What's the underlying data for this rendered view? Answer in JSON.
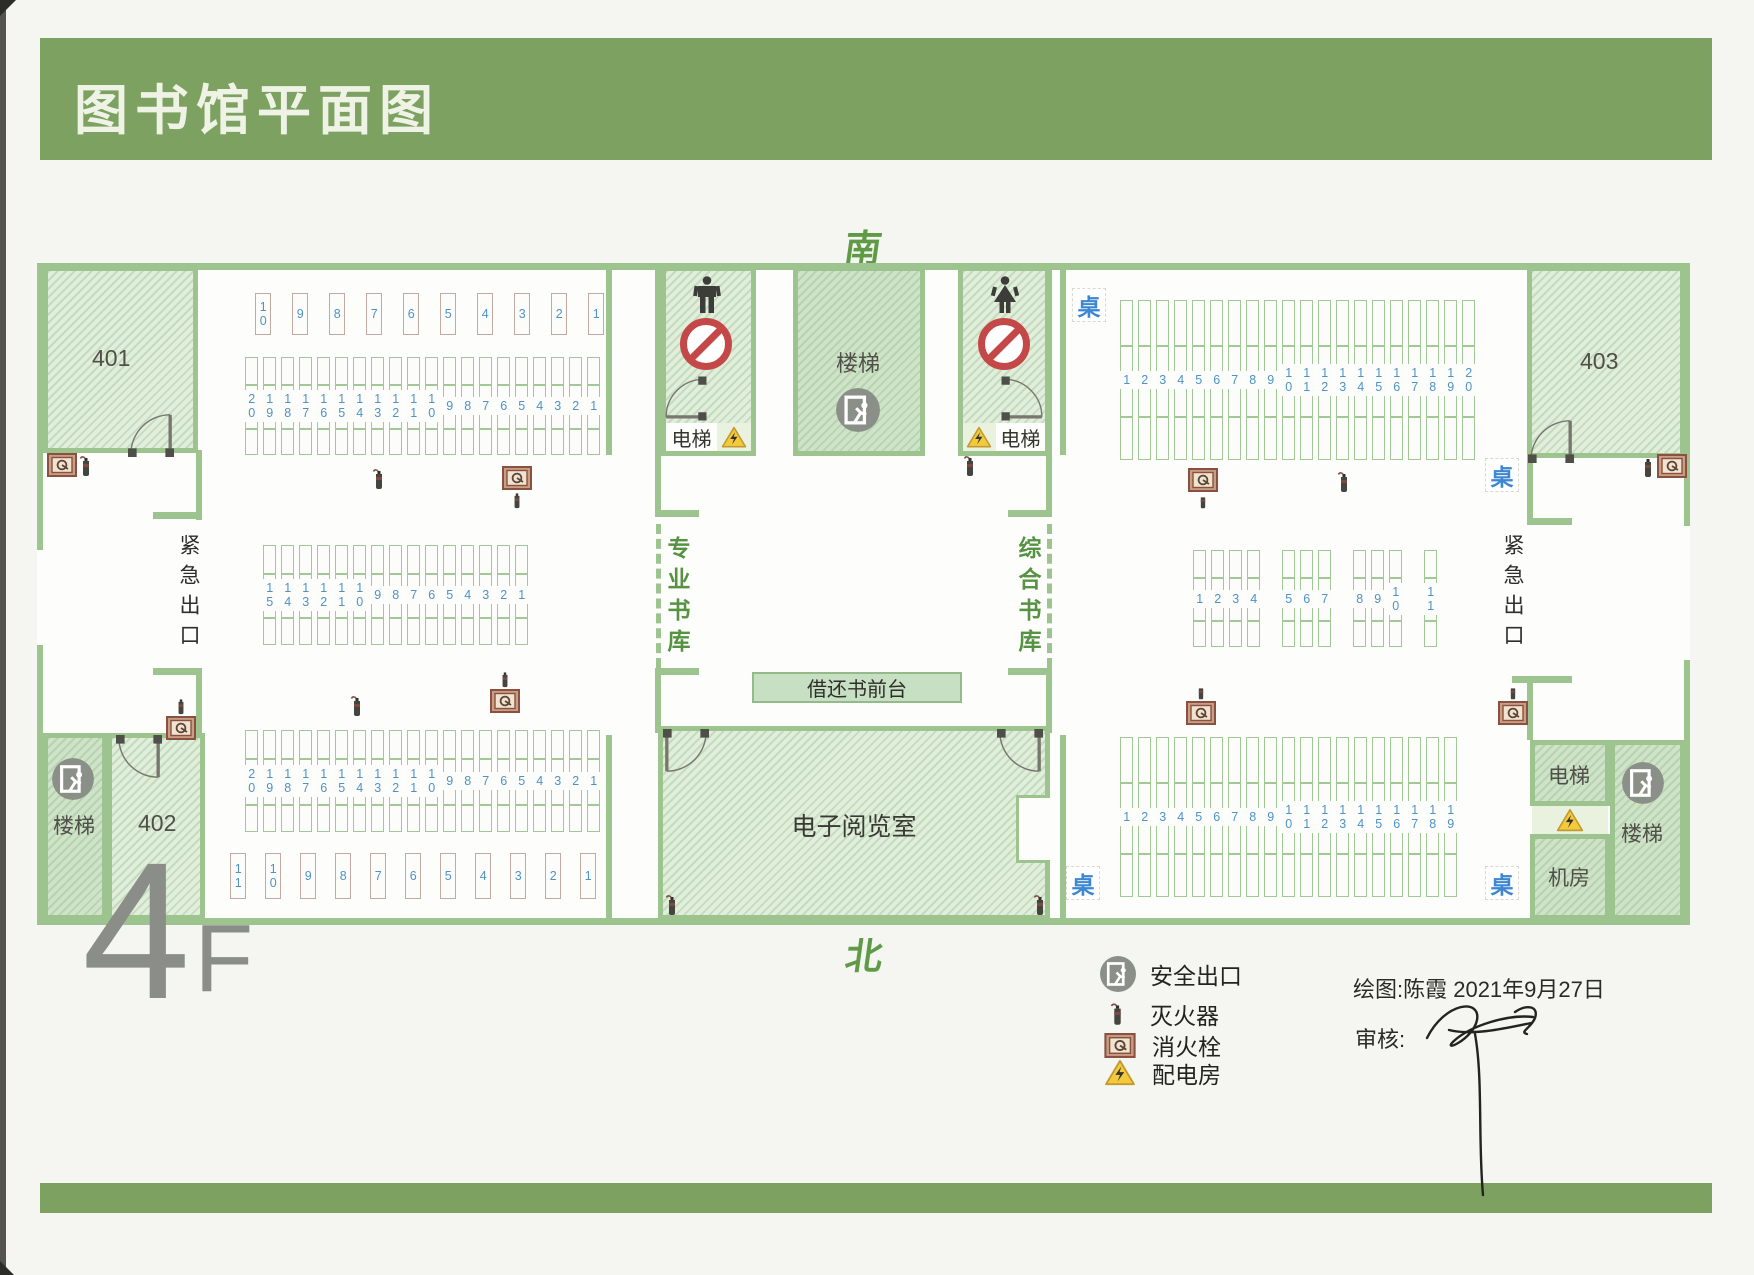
{
  "banner": {
    "title": "图书馆平面图"
  },
  "floor_label": {
    "big": "4",
    "small": "F"
  },
  "compass": {
    "south": "南",
    "north": "北",
    "east": "东",
    "west": "西"
  },
  "left_wing": {
    "room401": "401",
    "room402": "402",
    "stairs_label": "楼梯",
    "emergency_exit": "紧急出口",
    "rows": {
      "top": [
        "10",
        "9",
        "8",
        "7",
        "6",
        "5",
        "4",
        "3",
        "2",
        "1"
      ],
      "r2": [
        "20",
        "19",
        "18",
        "17",
        "16",
        "15",
        "14",
        "13",
        "12",
        "11",
        "10",
        "9",
        "8",
        "7",
        "6",
        "5",
        "4",
        "3",
        "2",
        "1"
      ],
      "r3": [
        "15",
        "14",
        "13",
        "12",
        "11",
        "10",
        "9",
        "8",
        "7",
        "6",
        "5",
        "4",
        "3",
        "2",
        "1"
      ],
      "r4": [
        "20",
        "19",
        "18",
        "17",
        "16",
        "15",
        "14",
        "13",
        "12",
        "11",
        "10",
        "9",
        "8",
        "7",
        "6",
        "5",
        "4",
        "3",
        "2",
        "1"
      ],
      "bottom": [
        "11",
        "10",
        "9",
        "8",
        "7",
        "6",
        "5",
        "4",
        "3",
        "2",
        "1"
      ]
    }
  },
  "center": {
    "stairs_label": "楼梯",
    "elevator_left": "电梯",
    "elevator_right": "电梯",
    "gate_left": "专业书库",
    "gate_right": "综合书库",
    "front_desk": "借还书前台",
    "reading_room": "电子阅览室"
  },
  "right_wing": {
    "room403": "403",
    "emergency_exit": "紧急出口",
    "elevator": "电梯",
    "machine_room": "机房",
    "stairs_label": "楼梯",
    "table_label": "桌",
    "rows": {
      "r1": [
        "1",
        "2",
        "3",
        "4",
        "5",
        "6",
        "7",
        "8",
        "9",
        "10",
        "11",
        "12",
        "13",
        "14",
        "15",
        "16",
        "17",
        "18",
        "19",
        "20"
      ],
      "r2_groups": [
        [
          "1",
          "2",
          "3",
          "4"
        ],
        [
          "5",
          "6",
          "7"
        ],
        [
          "8",
          "9",
          "10"
        ],
        [
          "11"
        ]
      ],
      "r3": [
        "1",
        "2",
        "3",
        "4",
        "5",
        "6",
        "7",
        "8",
        "9",
        "10",
        "11",
        "12",
        "13",
        "14",
        "15",
        "16",
        "17",
        "18",
        "19"
      ]
    }
  },
  "legend": {
    "items": [
      {
        "icon": "safety-exit-icon",
        "label": "安全出口"
      },
      {
        "icon": "fire-extinguisher-icon",
        "label": "灭火器"
      },
      {
        "icon": "fire-hydrant-icon",
        "label": "消火栓"
      },
      {
        "icon": "power-room-icon",
        "label": "配电房"
      }
    ]
  },
  "credits": {
    "drawn": "绘图:陈霞  2021年9月27日",
    "review": "审核:"
  },
  "colors": {
    "banner_green": "#7ca160",
    "wall_green": "#9dc48f",
    "room_fill": "#e1eedb",
    "shelf_number_blue": "#4e92c6",
    "table_blue": "#3c86d2",
    "compass_green": "#5f9b47",
    "no_smoking_red": "#c54848",
    "warning_yellow": "#f4ca3d",
    "exit_badge_gray": "#8a8f88"
  }
}
